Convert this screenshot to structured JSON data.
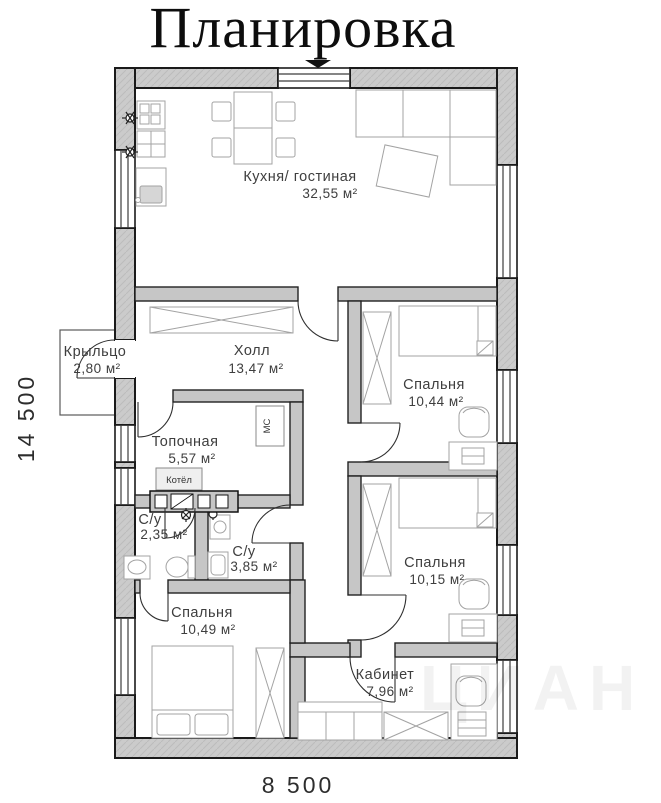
{
  "title": "Планировка",
  "dimensions": {
    "width": "8 500",
    "height": "14 500"
  },
  "rooms": [
    {
      "name": "Кухня/ гостиная",
      "area": "32,55 м²"
    },
    {
      "name": "Крыльцо",
      "area": "2,80 м²"
    },
    {
      "name": "Холл",
      "area": "13,47 м²"
    },
    {
      "name": "Спальня",
      "area": "10,44 м²"
    },
    {
      "name": "Топочная",
      "area": "5,57 м²"
    },
    {
      "name": "С/у",
      "area": "2,35 м²"
    },
    {
      "name": "С/у",
      "area": "3,85 м²"
    },
    {
      "name": "Спальня",
      "area": "10,15 м²"
    },
    {
      "name": "Спальня",
      "area": "10,49 м²"
    },
    {
      "name": "Кабинет",
      "area": "7,96 м²"
    }
  ],
  "equipment": {
    "boiler": "Котёл",
    "washing_machine": "МС"
  },
  "watermark": "ЦИАН",
  "colors": {
    "wall_fill": "#cbcbcb",
    "wall_hatch": "#bcbcbc",
    "wall_outline": "#1a1a1a",
    "furniture_stroke": "#a3a3a3",
    "label_text": "#3e3e3e"
  }
}
